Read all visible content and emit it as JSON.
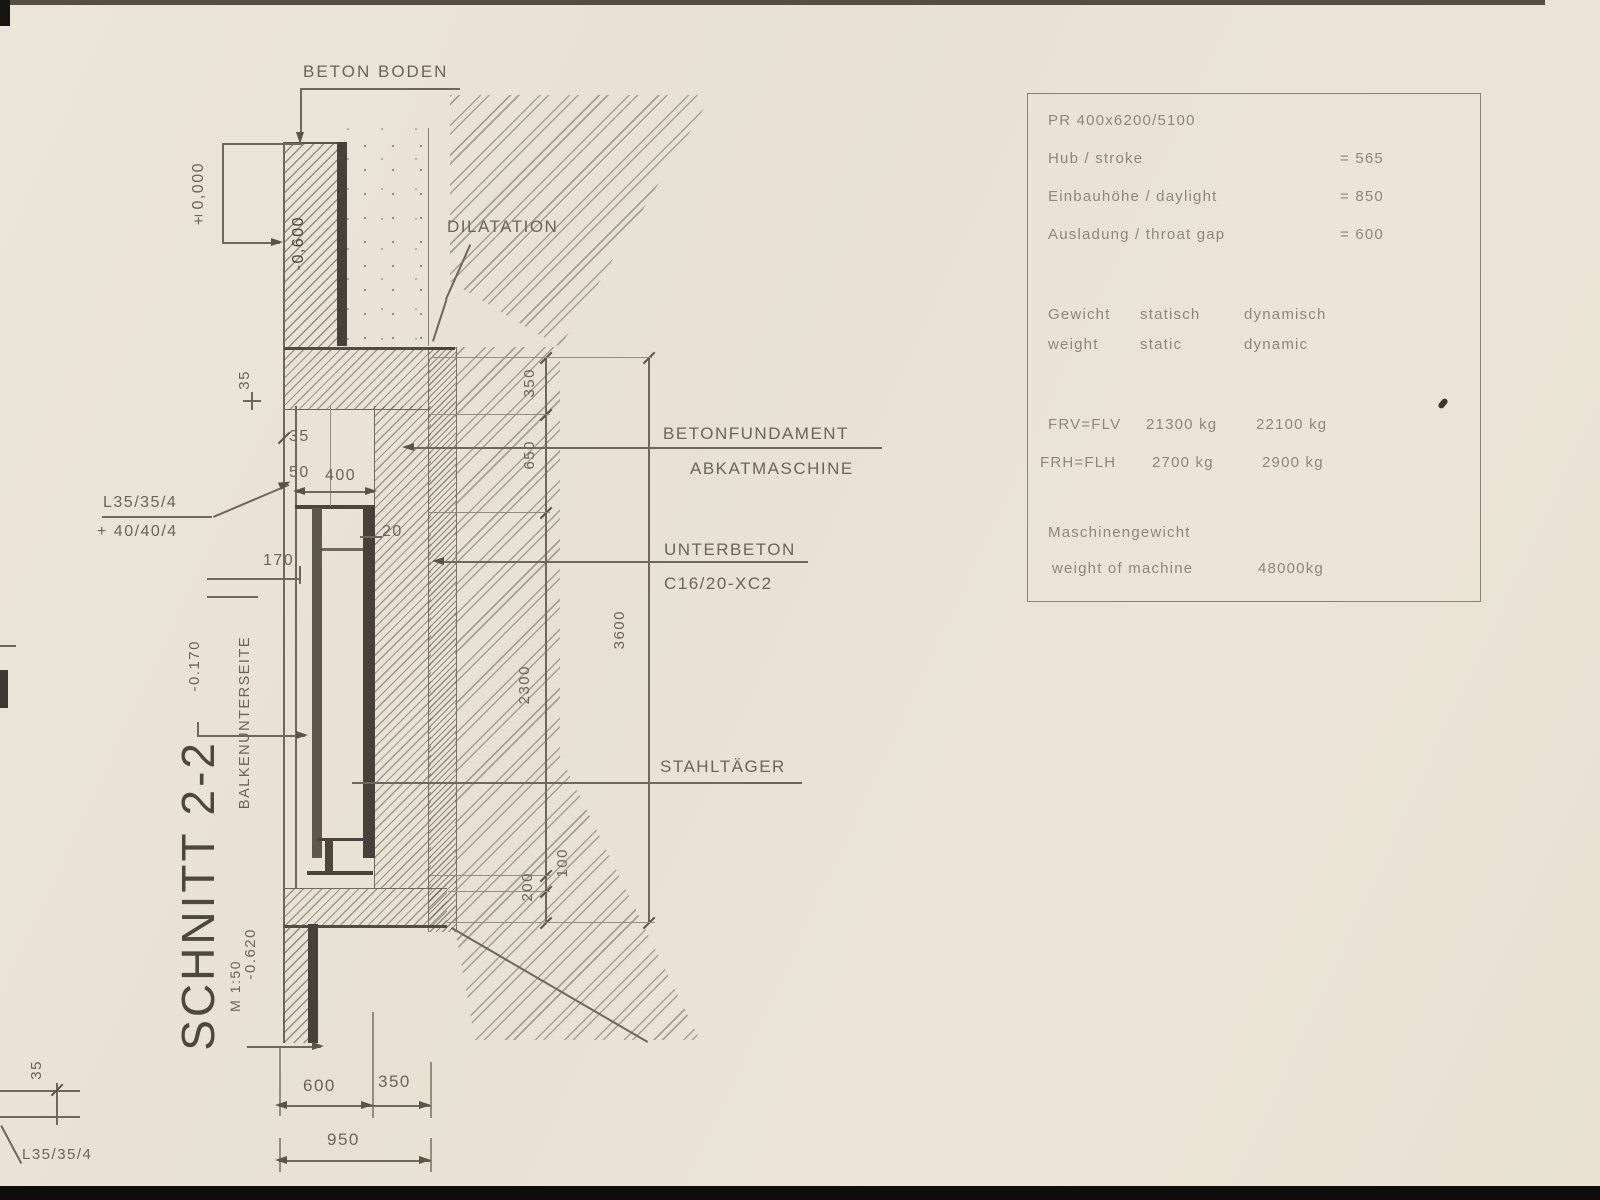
{
  "title_block": {
    "section_title": "SCHNITT 2-2",
    "scale": "M 1:50"
  },
  "annotations": {
    "beton_boden": "BETON BODEN",
    "dilatation": "DILATATION",
    "betonfundament": "BETONFUNDAMENT",
    "abkantmaschine": "ABKATMASCHINE",
    "unterbeton": "UNTERBETON",
    "unterbeton_grade": "C16/20-XC2",
    "stahltraeger": "STAHLTÄGER",
    "balkenunterseite": "BALKENUNTERSEITE",
    "angle_profile": "L35/35/4",
    "angle_profile_add": "+ 40/40/4",
    "angle_profile_bottom": "L35/35/4"
  },
  "levels": {
    "zero": "±0,000",
    "minus600": "-0,600",
    "minus170": "-0.170",
    "minus620": "-0.620"
  },
  "dimensions": {
    "v350": "350",
    "v650": "650",
    "v2300": "2300",
    "v100": "100",
    "v200": "200",
    "v3600": "3600",
    "h600": "600",
    "h350": "350",
    "h950": "950",
    "pit400": "400",
    "s35top": "35",
    "s35": "35",
    "s50": "50",
    "s20": "20",
    "s170": "170",
    "s35bl": "35"
  },
  "spec_table": {
    "model": "PR 400x6200/5100",
    "specs": [
      {
        "label": "Hub / stroke",
        "value": "= 565"
      },
      {
        "label": "Einbauhöhe / daylight",
        "value": "= 850"
      },
      {
        "label": "Ausladung / throat gap",
        "value": "= 600"
      }
    ],
    "weights_header": {
      "de": [
        "Gewicht",
        "statisch",
        "dynamisch"
      ],
      "en": [
        "weight",
        "static",
        "dynamic"
      ]
    },
    "weights": [
      {
        "name": "FRV=FLV",
        "static": "21300 kg",
        "dynamic": "22100 kg"
      },
      {
        "name": "FRH=FLH",
        "static": "2700 kg",
        "dynamic": "2900 kg"
      }
    ],
    "machine_weight": {
      "de": "Maschinengewicht",
      "en": "weight of machine",
      "value": "48000kg"
    }
  }
}
